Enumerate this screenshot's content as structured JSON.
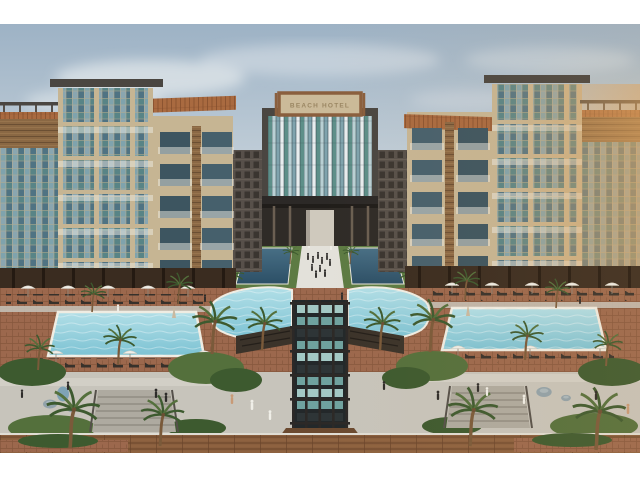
{
  "image": {
    "type": "architectural-rendering",
    "alt": "Aerial rendering of a U-shaped beach hotel resort: two five-story wings with glass, wood and terracotta facades around a palm courtyard with two dark lap pools and a white walkway crowded with people, a central glass tower topped by a framed hotel sign, a free-form pool around a dark slatted cascade pavilion, turquoise rectangular pools lined with sun loungers and white umbrellas, stone paths, stairs and a wooden boardwalk in front, under a soft blue sky",
    "sign_text": "BEACH HOTEL",
    "letterbox": {
      "top_bar_px": 24,
      "bottom_bar_px": 27
    }
  },
  "scene": {
    "left_wing": "five-story wing, glass curtain sections, wooden slats, white balcony rails, terracotta roof trim, rooftop pergolas",
    "right_wing": "mirrored wing with warm sunset reflections in the glass",
    "center_tower": "striped glass curtain wall with dark frame, entry portico and white feature wall",
    "courtyard": "lawn, two dark lap pools flanking a white walkway with a group of guests, rows of small palms",
    "pools": "free-form central pool around cascade pavilion, left and right rectangular turquoise pools",
    "foreground": "red paver terraces, sun loungers, white umbrellas, palms, stairs, boulders, wooden boardwalk"
  },
  "palette": {
    "sky_top": "#9db2c5",
    "sky_mid": "#c5d1da",
    "sky_low": "#e2e3e1",
    "cloud": "#eef1f2",
    "concrete": "#c6b593",
    "concrete_dark": "#a08a68",
    "mullion": "#bfae8c",
    "wood": "#8a6844",
    "wood_dark": "#6b4f33",
    "glass_deep": "#4f7383",
    "glass_mid": "#7fa3ad",
    "glass_light": "#b9d0d4",
    "glass_teal": "#5d8f89",
    "glass_warm": "#e0a55f",
    "roof": "#a96a40",
    "roof_dark": "#7c4828",
    "rail_white": "#eceae2",
    "slab": "#4a4641",
    "inner_wall": "#57504a",
    "lap_top": "#486f85",
    "lap_bottom": "#2c4f66",
    "pool_top": "#b2dfe7",
    "pool_bottom": "#7cc2d3",
    "coping": "#efece2",
    "paver": "#9c684d",
    "paver_line": "#7f5238",
    "path": "#c7c4bb",
    "path_dark": "#aeaaa0",
    "lawn": "#5d7b43",
    "leaf": "#3d5a2f",
    "leaf_light": "#54703c",
    "trunk": "#7a5a3a",
    "structure": "#2c2927",
    "panel": "#6fa29f",
    "panel_light": "#a3c8c4",
    "deck": "#8a5f3e",
    "deck_line": "#6a452b",
    "stone": "#91a2aa",
    "arcade": "#3a2c20",
    "column_dark": "#241a12",
    "lounger": "#37312b",
    "umbrella": "#efeee8",
    "figure_dark": "#2e2c2a",
    "figure_white": "#f0efe8",
    "skin": "#c89a76",
    "sign_face": "#cbba99",
    "sign_frame": "#8a5f3e",
    "sign_text": "#8f7a55"
  }
}
